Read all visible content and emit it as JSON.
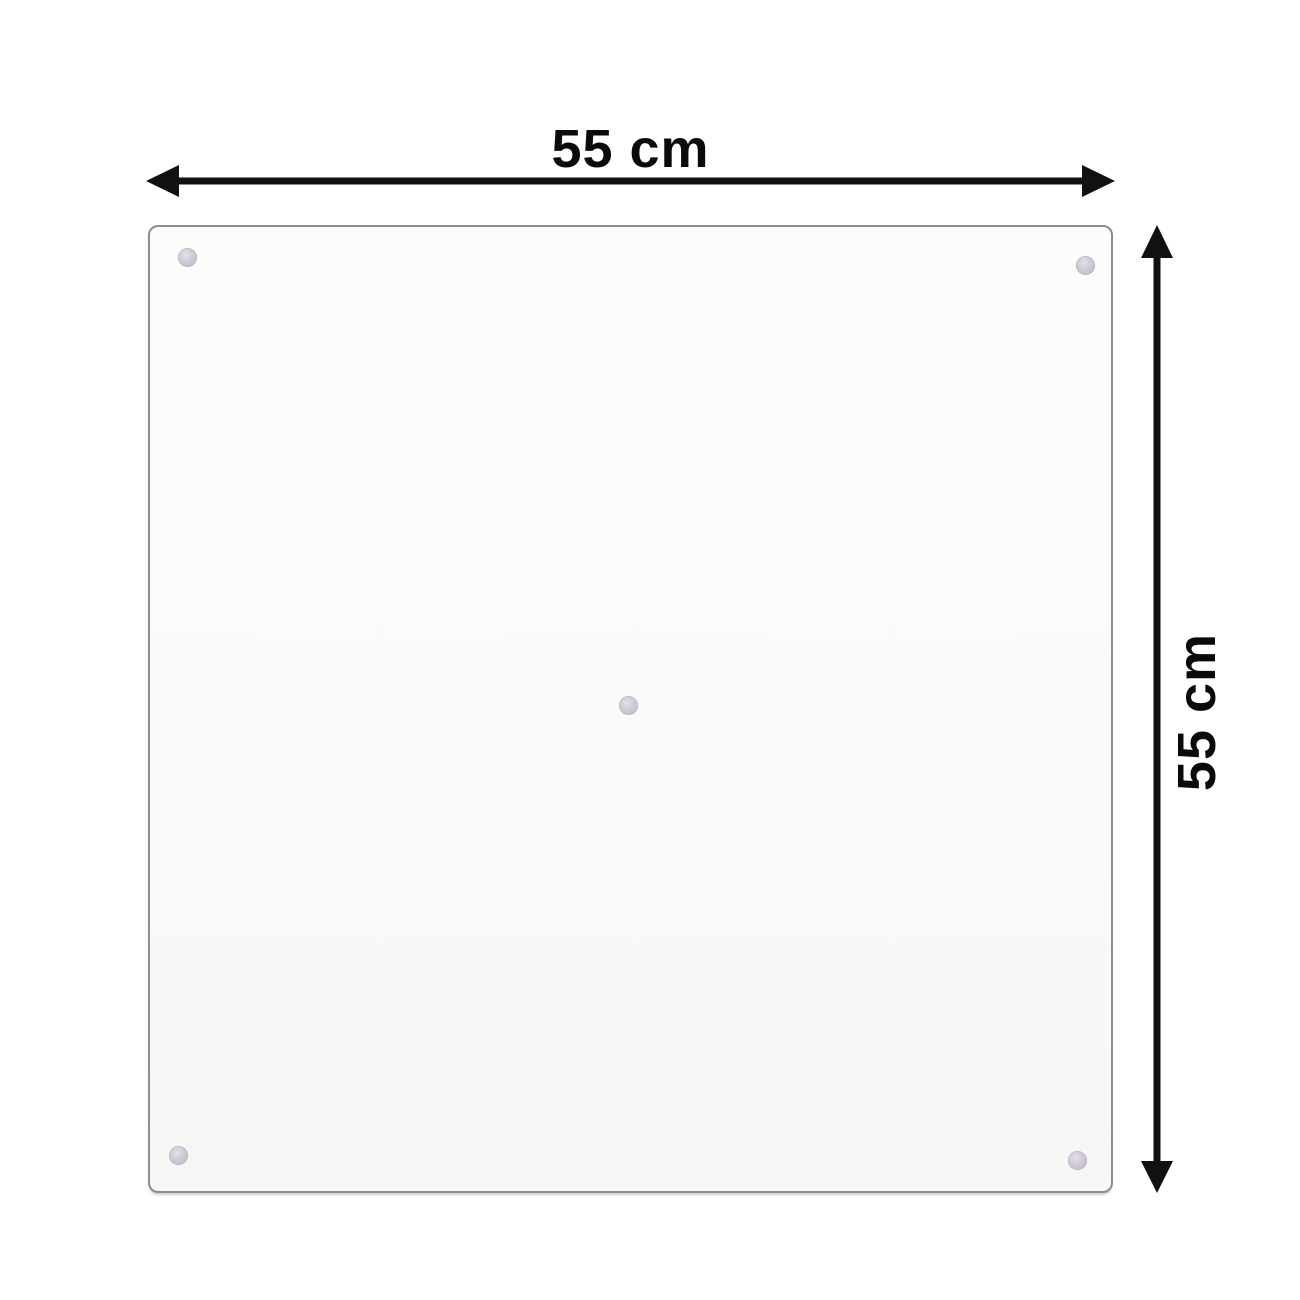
{
  "diagram": {
    "title": "glass panel dimension diagram",
    "top_dimension": {
      "label": "55 cm"
    },
    "right_dimension": {
      "label": "55 cm"
    },
    "icons": {
      "horizontal_arrow": "double-headed-arrow-left-right",
      "vertical_arrow": "double-headed-arrow-up-down",
      "suction_cups": "circle-dot"
    },
    "colors": {
      "background": "#ffffff",
      "arrow": "#111111",
      "label": "#0a0a0a",
      "panel_fill": "#fbfbfa",
      "panel_border": "#8d8d8d",
      "suction_cup": "#c8c3cf"
    }
  }
}
